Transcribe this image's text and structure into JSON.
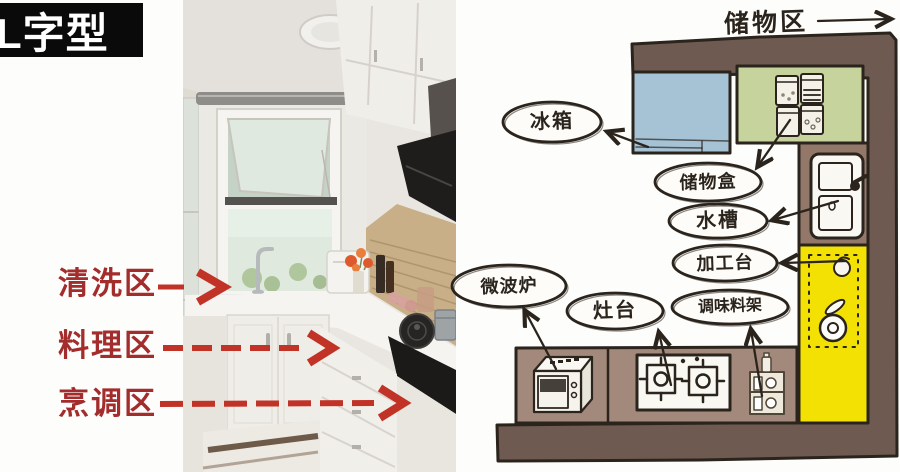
{
  "title": "L字型",
  "colors": {
    "accent_red": "#a32c2c",
    "arrow_red": "#c23327",
    "ink": "#2b241d",
    "cabinet_dark": "#6e5a50",
    "counter_mauve": "#a3897b",
    "fridge_blue": "#a6c3d6",
    "window_green": "#c6d39c",
    "prep_yellow": "#f2e103",
    "paper": "#fdfdfb"
  },
  "left_annotations": {
    "items": [
      {
        "id": "washing-zone",
        "label": "清洗区"
      },
      {
        "id": "prep-zone",
        "label": "料理区"
      },
      {
        "id": "cooking-zone",
        "label": "烹调区"
      }
    ]
  },
  "diagram": {
    "storage_area_label": "储物区",
    "callouts": {
      "fridge": "冰箱",
      "storage_box": "储物盒",
      "sink": "水槽",
      "prep_counter": "加工台",
      "microwave": "微波炉",
      "stove": "灶台",
      "spice_rack": "调味料架"
    }
  }
}
